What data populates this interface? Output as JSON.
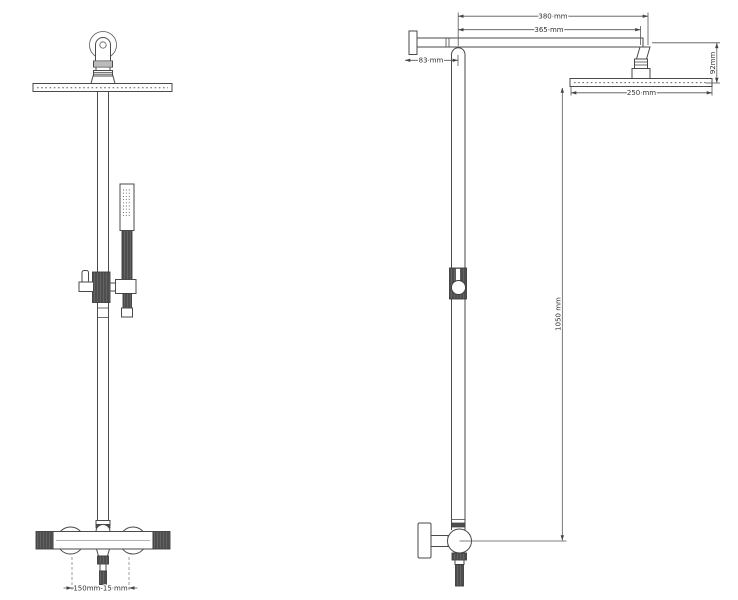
{
  "drawing": {
    "type": "shower-system-technical-drawing",
    "background": "#ffffff",
    "line_color": "#4a4a4a",
    "dim_color": "#555555"
  },
  "views": {
    "front": {
      "dim_outlet_spacing": "150mm-15 mm"
    },
    "side": {
      "dim_arm_overall": "380 mm",
      "dim_arm_to_head": "365 mm",
      "dim_wall_offset": "83 mm",
      "dim_head_drop": "92mm",
      "dim_head_diameter": "250 mm",
      "dim_riser_height": "1050 mm"
    }
  }
}
